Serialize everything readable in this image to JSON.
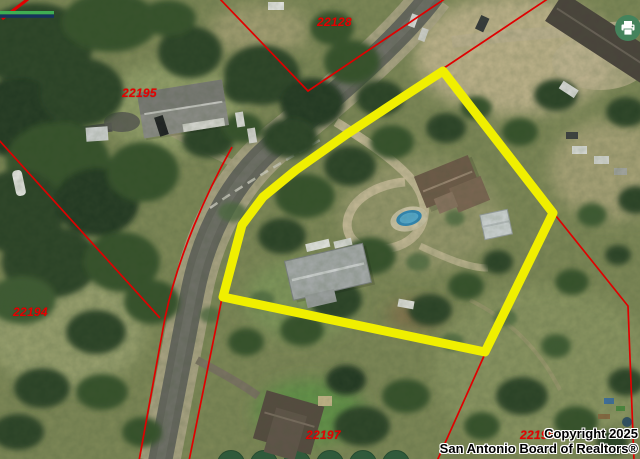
{
  "map": {
    "type": "aerial-parcel-map",
    "parcels": [
      {
        "id": "22128"
      },
      {
        "id": "22195"
      },
      {
        "id": "22194"
      },
      {
        "id": "22197"
      },
      {
        "id": "22198"
      }
    ],
    "copyright": {
      "line1": "Copyright 2025",
      "line2": "San Antonio Board of Realtors®"
    }
  },
  "controls": {
    "print_button": {
      "icon": "printer-icon"
    }
  },
  "colors": {
    "boundary_highlight": "#f0ef00",
    "parcel_line": "#e00000",
    "parcel_label_text": "#e60000",
    "copyright_text": "#000000",
    "print_button_bg": "#44835c",
    "scalebar_green": "#3fae53",
    "scalebar_navy": "#16325c"
  }
}
